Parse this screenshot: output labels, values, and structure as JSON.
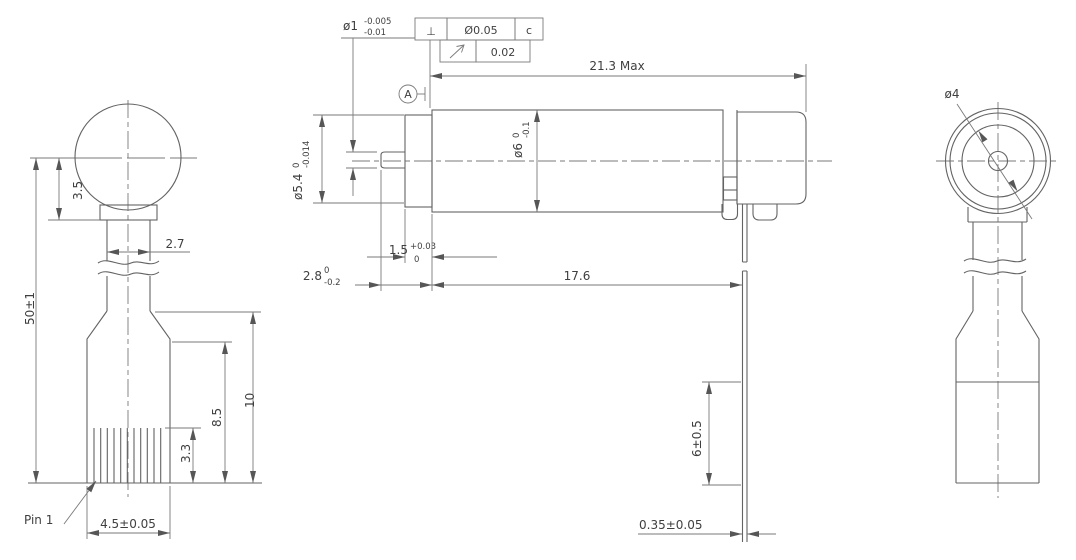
{
  "background": "#ffffff",
  "palette": {
    "line_color": "#636363",
    "dim_line_color": "#7a7a7a",
    "text_color": "#3f3f3f"
  },
  "left_view": {
    "pin_label": "Pin 1",
    "dim_head_offset": "3.5",
    "dim_neck_width": "2.7",
    "dim_total_height": "50±1",
    "dim_body_upper": "8.5",
    "dim_body_total": "10",
    "dim_rib_height": "3.3",
    "dim_base_width": "4.5±0.05"
  },
  "front_view": {
    "shaft_dia": {
      "main": "ø1",
      "upper": "-0.005",
      "lower": "-0.01"
    },
    "fcf": {
      "perpendicularity_symbol": "⊥",
      "perpendicularity_tolerance": "Ø0.05",
      "perpendicularity_datum": "c",
      "runout_tolerance": "0.02"
    },
    "datum_label": "A",
    "dim_max_length": "21.3 Max",
    "flange_dia": {
      "main": "ø5.4",
      "upper": "0",
      "lower": "-0.014"
    },
    "body_dia": {
      "main": "ø6",
      "upper": "0",
      "lower": "-0.1"
    },
    "bushing_length": {
      "main": "1.5",
      "upper": "+0.03",
      "lower": "0"
    },
    "shaft_protrusion": {
      "main": "2.8",
      "upper": "0",
      "lower": "-0.2"
    },
    "dim_body_length": "17.6",
    "dim_lead_length": "6±0.5",
    "dim_lead_thickness": "0.35±0.05"
  },
  "end_view": {
    "dim_inner_dia": "ø4"
  }
}
